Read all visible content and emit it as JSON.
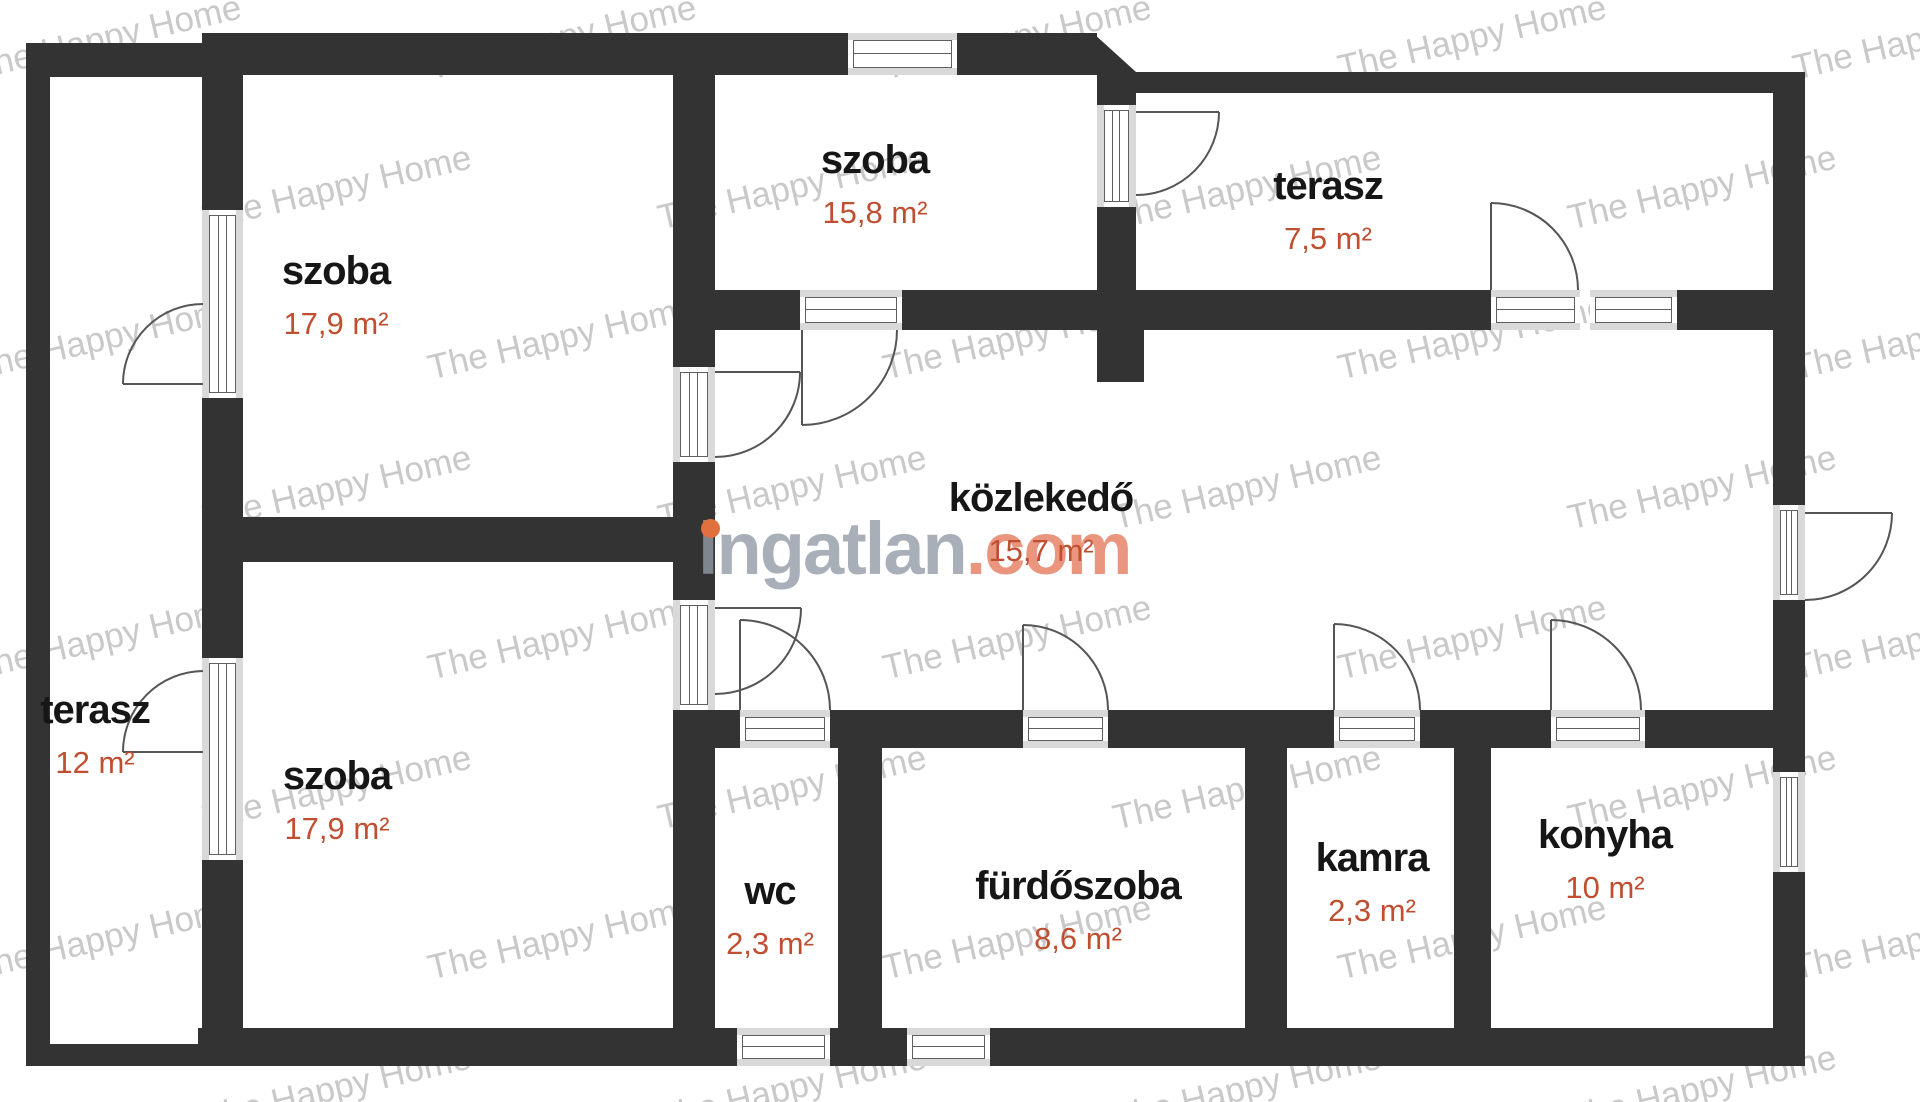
{
  "plan": {
    "title": "floor plan",
    "rooms": [
      {
        "id": "szoba-top-left",
        "name": "szoba",
        "area": "17,9 m²"
      },
      {
        "id": "szoba-top-middle",
        "name": "szoba",
        "area": "15,8 m²"
      },
      {
        "id": "terasz-top-right",
        "name": "terasz",
        "area": "7,5 m²"
      },
      {
        "id": "kozlekedo",
        "name": "közlekedő",
        "area": "15,7 m²"
      },
      {
        "id": "terasz-left",
        "name": "terasz",
        "area": "12 m²"
      },
      {
        "id": "szoba-bottom-left",
        "name": "szoba",
        "area": "17,9 m²"
      },
      {
        "id": "wc",
        "name": "wc",
        "area": "2,3 m²"
      },
      {
        "id": "furdoszoba",
        "name": "fürdőszoba",
        "area": "8,6 m²"
      },
      {
        "id": "kamra",
        "name": "kamra",
        "area": "2,3 m²"
      },
      {
        "id": "konyha",
        "name": "konyha",
        "area": "10 m²"
      }
    ],
    "colors": {
      "wall": "#333333",
      "sill": "#d9d9d9",
      "room_text": "#161616",
      "area_text": "#bf4f30",
      "logo_gray": "#949ba6",
      "logo_salmon": "#e7886c",
      "logo_dot_orange": "#e0703e",
      "tile_gray": "#c9c9c9"
    }
  },
  "watermark": {
    "tile_text": "The Happy Home",
    "logo_text_gray": "ingatlan",
    "logo_text_salmon": ".com"
  }
}
